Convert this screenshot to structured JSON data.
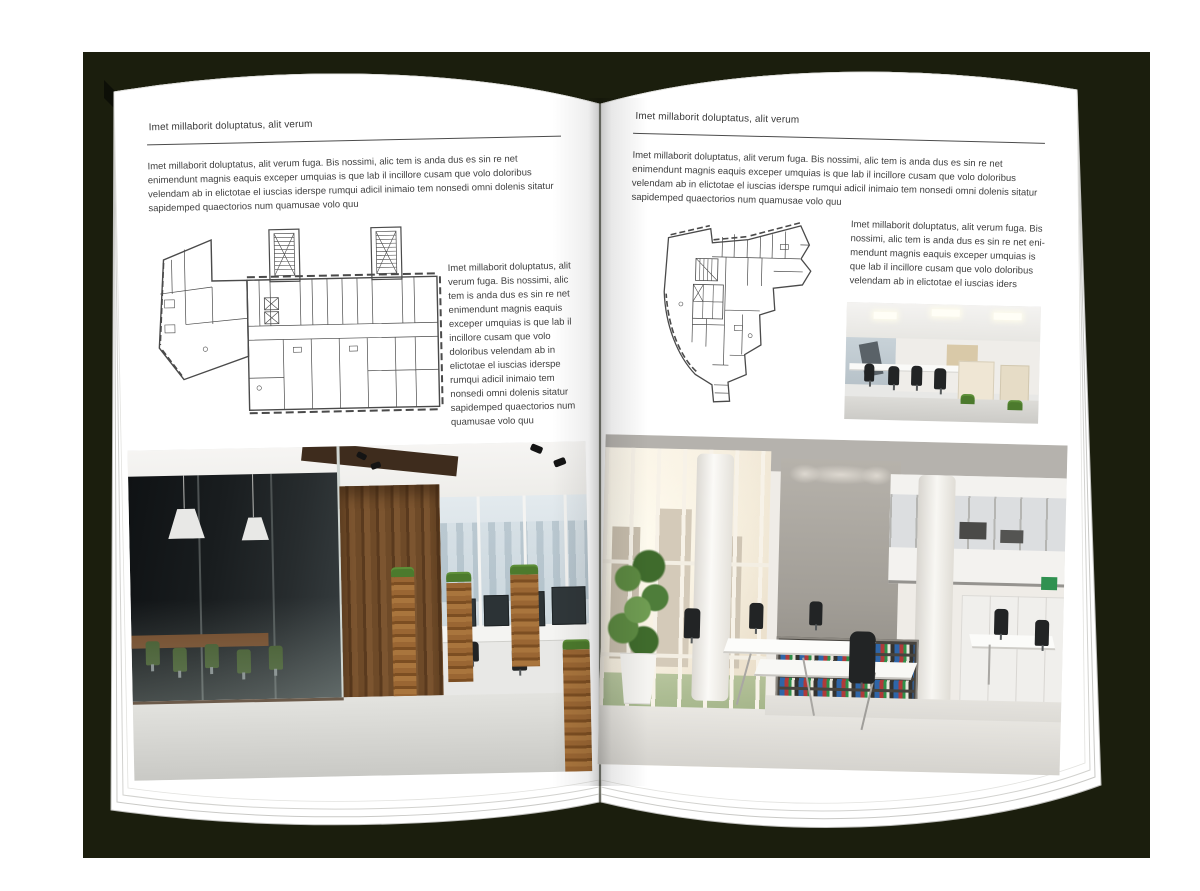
{
  "colors": {
    "backdrop": "#1b1e0d",
    "page": "#ffffff",
    "body_text": "#3f3f3f",
    "rule": "#4c4c4c",
    "plan_line": "#4a4a4a"
  },
  "left_page": {
    "header": "Imet millaborit doluptatus, alit verum",
    "intro": "Imet millaborit doluptatus, alit verum fuga. Bis nossimi, alic tem is anda dus es sin re net enimendunt magnis eaquis exceper umquias is que lab il incillore cusam que volo doloribus velendam ab in elictotae el iuscias iderspe rumqui adicil inimaio tem nonsedi omni dolenis sitatur sapidemped quaectorios num quamusae volo quu",
    "side_text": "Imet millaborit doluptatus, alit verum fuga. Bis nossimi, alic tem is anda dus es sin re net enimendunt magnis eaquis exceper umquias is que lab il incillore cusam que volo doloribus velendam ab in elictotae el iuscias iderspe rumqui adicil inimaio tem nonsedi omni dolenis sitatur sapidemped quaectorios num quamusae volo quu"
  },
  "right_page": {
    "header": "Imet millaborit doluptatus, alit verum",
    "intro": "Imet millaborit doluptatus, alit verum fuga. Bis nossimi, alic tem is anda dus es sin re net enimendunt magnis eaquis exceper umquias is que lab il incillore cusam que volo doloribus velendam ab in elictotae el iuscias iderspe rumqui adicil inimaio tem nonsedi omni dolenis sitatur sapidemped quaectorios num quamusae volo quu",
    "side_text": "Imet millaborit doluptatus, alit verum fuga. Bis nossimi, alic tem is anda dus es sin re net eni-mendunt magnis eaquis exceper umquias is que lab il incillore cusam que volo doloribus velendam ab in elictotae el iuscias iders"
  }
}
